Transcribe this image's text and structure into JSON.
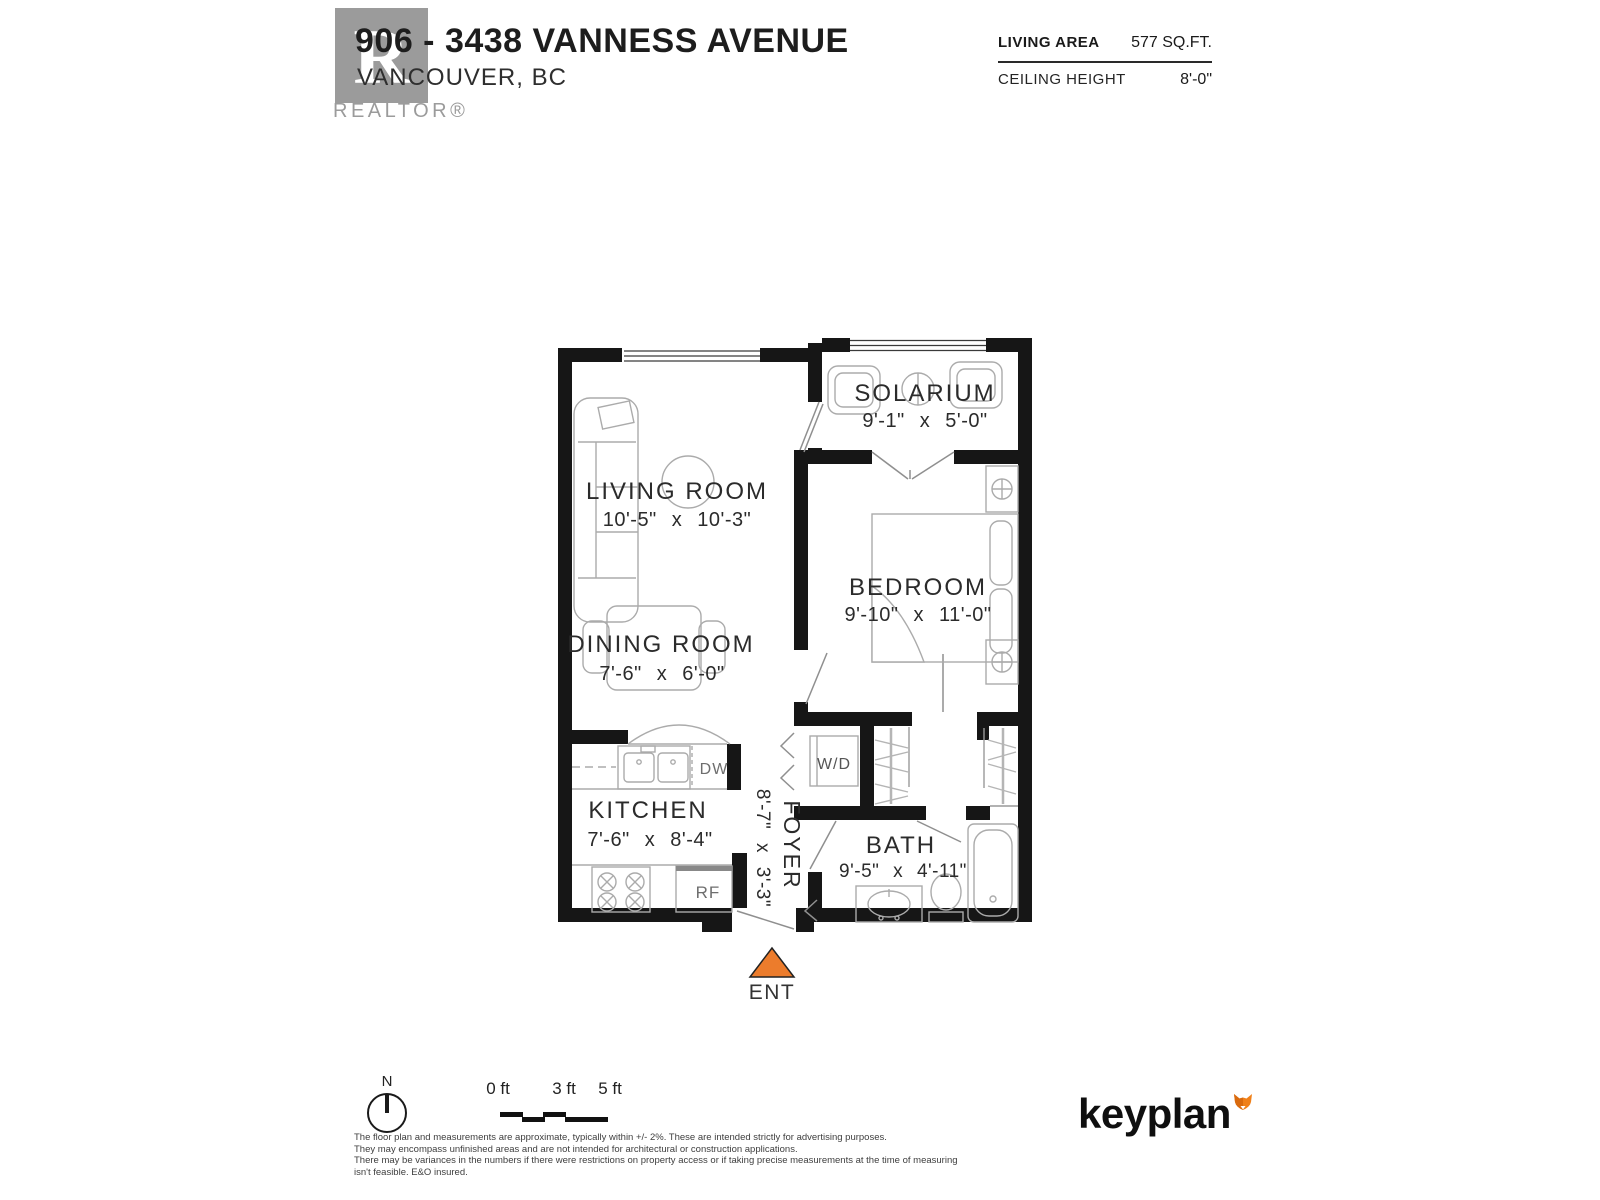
{
  "header": {
    "title": "906 - 3438 VANNESS AVENUE",
    "subtitle": "VANCOUVER, BC",
    "logo_letter": "R",
    "logo_brand": "REALTOR®"
  },
  "stats": {
    "living_area_label": "LIVING AREA",
    "living_area_value": "577 SQ.FT.",
    "ceiling_label": "CEILING HEIGHT",
    "ceiling_value": "8'-0\""
  },
  "rooms": {
    "living": {
      "name": "LIVING ROOM",
      "dims": "10'-5\" x 10'-3\""
    },
    "solarium": {
      "name": "SOLARIUM",
      "dims": "9'-1\" x 5'-0\""
    },
    "bedroom": {
      "name": "BEDROOM",
      "dims": "9'-10\" x 11'-0\""
    },
    "dining": {
      "name": "DINING ROOM",
      "dims": "7'-6\" x 6'-0\""
    },
    "kitchen": {
      "name": "KITCHEN",
      "dims": "7'-6\" x 8'-4\""
    },
    "foyer": {
      "name": "FOYER",
      "dims": "8'-7\" x 3'-3\""
    },
    "bath": {
      "name": "BATH",
      "dims": "9'-5\" x 4'-11\""
    }
  },
  "fixtures": {
    "washer_dryer": "W/D",
    "dishwasher": "DW",
    "refrigerator": "RF"
  },
  "entry": {
    "label": "ENT",
    "arrow_color": "#EC7C2C"
  },
  "compass": {
    "label": "N"
  },
  "scale_bar": {
    "ticks": [
      "0 ft",
      "3 ft",
      "5 ft"
    ]
  },
  "disclaimer": [
    "The floor plan and measurements are approximate, typically within +/- 2%. These are intended strictly for advertising purposes.",
    "They may encompass unfinished areas and are not intended for architectural or construction applications.",
    "There may be variances in the numbers if there were restrictions on property access or if taking precise measurements at the time of measuring isn't feasible. E&O insured."
  ],
  "brand": {
    "name": "keyplan",
    "fox_color": "#F08019"
  },
  "colors": {
    "wall": "#161616",
    "furniture": "#ababab",
    "accent_orange": "#EC7C2C",
    "logo_gray": "#9B9B9B"
  }
}
